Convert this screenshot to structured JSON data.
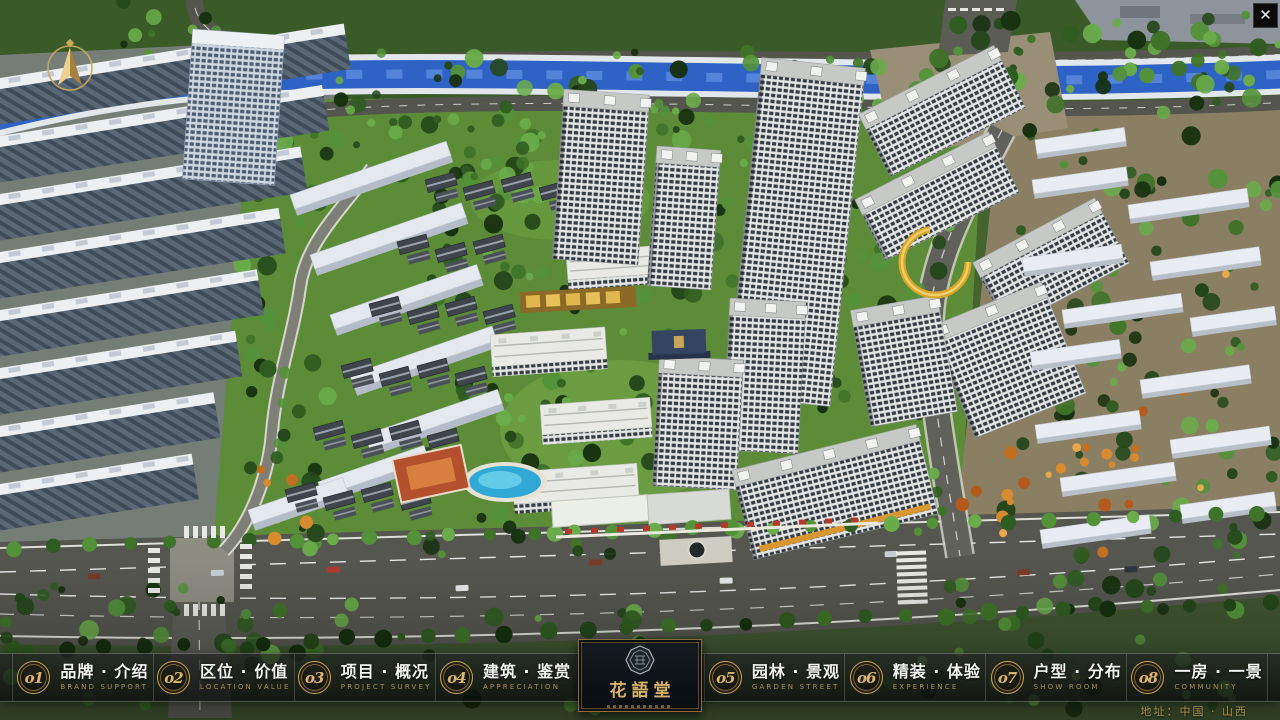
{
  "window": {
    "close_glyph": "✕"
  },
  "nav": {
    "items": [
      {
        "num": "o1",
        "zh": "品牌 · 介绍",
        "en": "BRAND SUPPORT"
      },
      {
        "num": "o2",
        "zh": "区位 · 价值",
        "en": "LOCATION VALUE"
      },
      {
        "num": "o3",
        "zh": "项目 · 概况",
        "en": "PROJECT SURVEY"
      },
      {
        "num": "o4",
        "zh": "建筑 · 鉴赏",
        "en": "APPRECIATION"
      },
      {
        "num": "o5",
        "zh": "园林 · 景观",
        "en": "GARDEN STREET"
      },
      {
        "num": "o6",
        "zh": "精装 · 体验",
        "en": "EXPERIENCE"
      },
      {
        "num": "o7",
        "zh": "户型 · 分布",
        "en": "SHOW ROOM"
      },
      {
        "num": "o8",
        "zh": "一房 · 一景",
        "en": "COMMUNITY"
      }
    ]
  },
  "logo": {
    "title": "花語堂"
  },
  "footer": {
    "address": "地址：中国 · 山西"
  },
  "colors": {
    "accent_gold": "#c9a55a",
    "badge_number": "#d9b669",
    "nav_en_text": "#a98e54",
    "bar_bg": "rgba(16,18,18,0.72)",
    "panel_bg": "#0d1116",
    "river_blue": "#2e62c4",
    "community_green": "#5c8c38"
  }
}
